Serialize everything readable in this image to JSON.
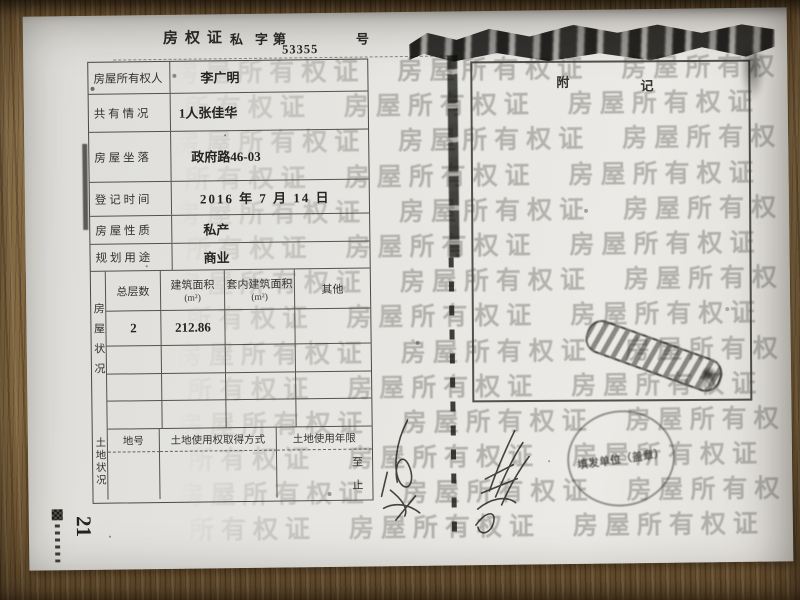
{
  "header": {
    "title": "房权证",
    "type_char": "私",
    "prefix": "字第",
    "serial": "53355",
    "suffix": "号"
  },
  "fields": [
    {
      "label": "房屋所有权人",
      "value": "李广明"
    },
    {
      "label": "共 有 情 况",
      "value": "1人张佳华"
    },
    {
      "label": "房 屋 坐 落",
      "value": "政府路46-03"
    },
    {
      "label": "登 记 时 间",
      "value": "2016 年 7 月 14 日"
    },
    {
      "label": "房 屋 性 质",
      "value": "私产"
    },
    {
      "label": "规 划 用 途",
      "value": "商业"
    }
  ],
  "housing": {
    "side_label": "房屋状况",
    "columns": [
      {
        "title": "总层数",
        "unit": ""
      },
      {
        "title": "建筑面积",
        "unit": "(m²)"
      },
      {
        "title": "套内建筑面积",
        "unit": "(m²)"
      },
      {
        "title": "其他",
        "unit": ""
      }
    ],
    "rows": [
      [
        "2",
        "212.86",
        "",
        ""
      ],
      [
        "",
        "",
        "",
        ""
      ],
      [
        "",
        "",
        "",
        ""
      ],
      [
        "",
        "",
        "",
        ""
      ]
    ]
  },
  "land": {
    "side_label": "土地状况",
    "columns": [
      "地号",
      "土地使用权取得方式",
      "土地使用年限"
    ],
    "term_from": "至",
    "term_to": "止"
  },
  "annex": {
    "char_left": "附",
    "char_right": "记"
  },
  "watermark": {
    "text": "房屋所有权证",
    "rows": 14,
    "repeat": 5
  },
  "stamps": {
    "round_text": "填发单位（盖章）"
  },
  "photo": {
    "page_number": "21"
  },
  "colors": {
    "paper": "#e6e5e1",
    "ink": "#2a2a27",
    "wood": "#9a7a50",
    "watermark": "#49493f",
    "toner": "#0e0e0b"
  }
}
